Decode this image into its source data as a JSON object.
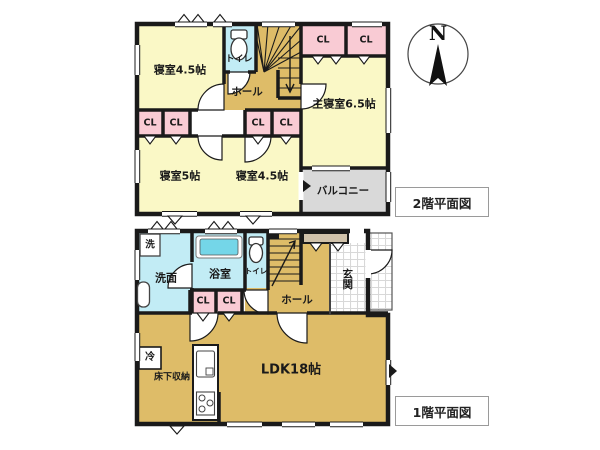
{
  "colors": {
    "room_yellow": "#FAF8C6",
    "floor_tan": "#DEBC68",
    "water_cyan": "#C2ECF5",
    "tub_cyan": "#74D6E8",
    "closet_pink": "#F9CBD4",
    "balcony_gray": "#D9D9D9",
    "cabinet_tan": "#D0C2AA",
    "wall_black": "#1A1A1A"
  },
  "compass": {
    "north_label": "N"
  },
  "labels": {
    "closet": "CL"
  },
  "floor2": {
    "title": "2階平面図",
    "rooms": {
      "bedroom_a": "寝室4.5帖",
      "toilet": "トイレ",
      "hall": "ホール",
      "master_bedroom": "主寝室6.5帖",
      "bedroom_b": "寝室5帖",
      "bedroom_c": "寝室4.5帖",
      "balcony": "バルコニー"
    }
  },
  "floor1": {
    "title": "1階平面図",
    "rooms": {
      "laundry": "洗",
      "washroom": "洗面",
      "bathroom": "浴室",
      "toilet": "トイレ",
      "hall": "ホール",
      "entrance": "玄関",
      "ldk": "LDK18帖",
      "fridge": "冷",
      "underfloor_storage": "床下収納"
    }
  }
}
